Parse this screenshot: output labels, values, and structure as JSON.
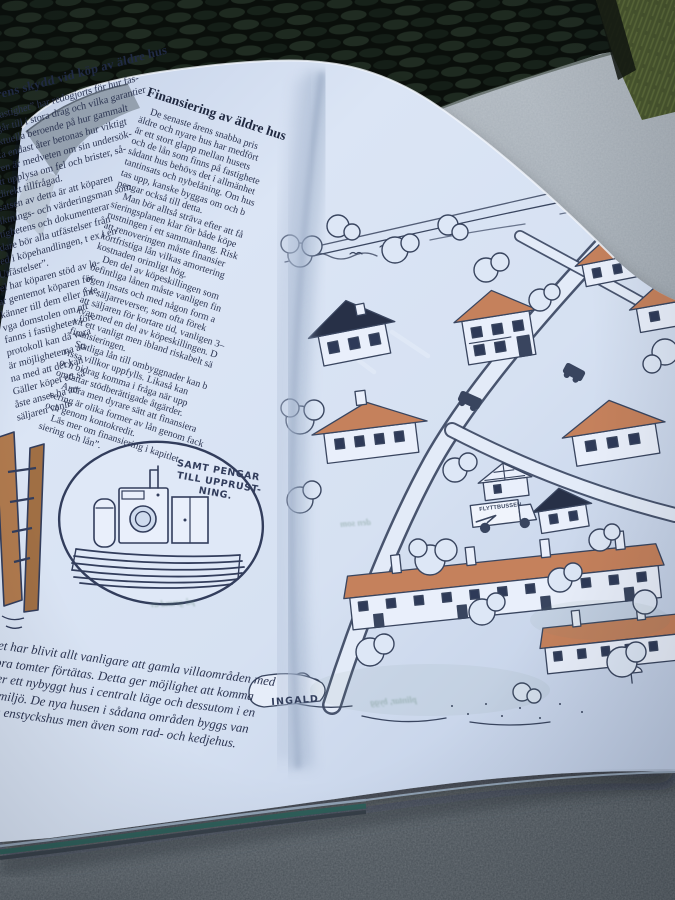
{
  "colors": {
    "page": "#d8e2f3",
    "ink": "#39455f",
    "text_ink": "#2c3552",
    "roof_orange": "#c5815c",
    "roof_dark": "#273047",
    "wicker_dark": "#0a0f0b",
    "grass_green": "#49562e",
    "table_gray": "#9fa8b1",
    "cover_teal": "#2f5f5a"
  },
  "left_page": {
    "left_column": {
      "heading": "Köparens skydd vid köp av äldre hus",
      "lines": [
        "“köpa fastighet” har redogjorts för hur fas-",
        "köpet går till i stora drag och vilka garantier",
        "vara aktuella beroende på hur gammalt",
        "blir ska endast åter betonas hur viktigt",
        "köparen är medveten om sin undersök-",
        "het att upplysa om fel och brister, så-",
        "blir direkt tillfrågad.",
        "slutsatsen av detta är att köparen",
        "besiktnings- och värderingsman som",
        "fastighetens och dokumenterar",
        "Vidare bör alla utfästelser från",
        "med i köpehandlingen, t ex i en",
        "“Utfästelser”.",
        "fel har köparen stöd av la-",
        "ar gentemot köparen för",
        "känner till dem eller inte.",
        "vga domstolen om att",
        "fanns i fastigheten före",
        "protokoll kan då vara",
        "är möjligheterna att",
        "na med att det kan",
        "Gäller köpet ett så",
        "åste anses ha an-",
        "säljaren vanli-"
      ]
    },
    "right_column": {
      "heading": "Finansiering av äldre hus",
      "lines": [
        "De senaste årens snabba pris",
        "äldre och nyare hus har medfört",
        "är ett stort glapp mellan husets",
        "och de lån som finns på fastighete",
        "sådant hus behövs det i allmänhet",
        "tantinsats och nybelåning. Om hus",
        "tas upp, kanske byggas om och b",
        "pengar också till detta.",
        "Man bör alltså sträva efter att få",
        "sieringsplanen klar för både köpe",
        "rustningen i ett sammanhang. Risk",
        "att renoveringen måste finansier",
        "kortfristiga lån vilkas amortering",
        "kostnaden orimligt hög.",
        "Den del av köpeskillingen som",
        "befintliga lånen måste vanligen fin",
        "egen insats och med någon form a",
        "s k säljarreverser, som ofta förek",
        "att säljaren för kortare tid, vanligen 3–",
        "kvar med en del av köpeskillingen. D",
        "vit ett vanligt men ibland riskabelt sä",
        "finansieringen.",
        "Statliga lån till ombyggnader kan b",
        "vissa villkor uppfylls. Likaså kan",
        "och bidrag komma i fråga när upp",
        "omfattar stödberättigade åtgärder.",
        "Andra men dyrare sätt att finansiera",
        "vering är olika former av lån genom fack",
        "och genom kontokredit.",
        "Läs mer om finansiering i kapitlet",
        "siering och lån”."
      ]
    },
    "cartoon": {
      "caption_lines": [
        "SAMT PENGAR",
        "TILL UPPRUST-",
        "NING."
      ]
    },
    "caption_lines": [
      "Det har blivit allt vanligare att gamla villaområden med",
      "stora tomter förtätas. Detta ger möjlighet att komma",
      "över ett nybyggt hus i centralt läge och dessutom i en",
      "dd miljö. De nya husen i sådana områden byggs van",
      "som enstyckshus men även som rad- och kedjehus."
    ]
  },
  "right_page": {
    "illustration": {
      "signature": "INGALD",
      "van_label": "FLYTTBUSSEN",
      "show_through_fragments": [
        "den som",
        "på grund av",
        "plintar, bygg"
      ]
    }
  }
}
